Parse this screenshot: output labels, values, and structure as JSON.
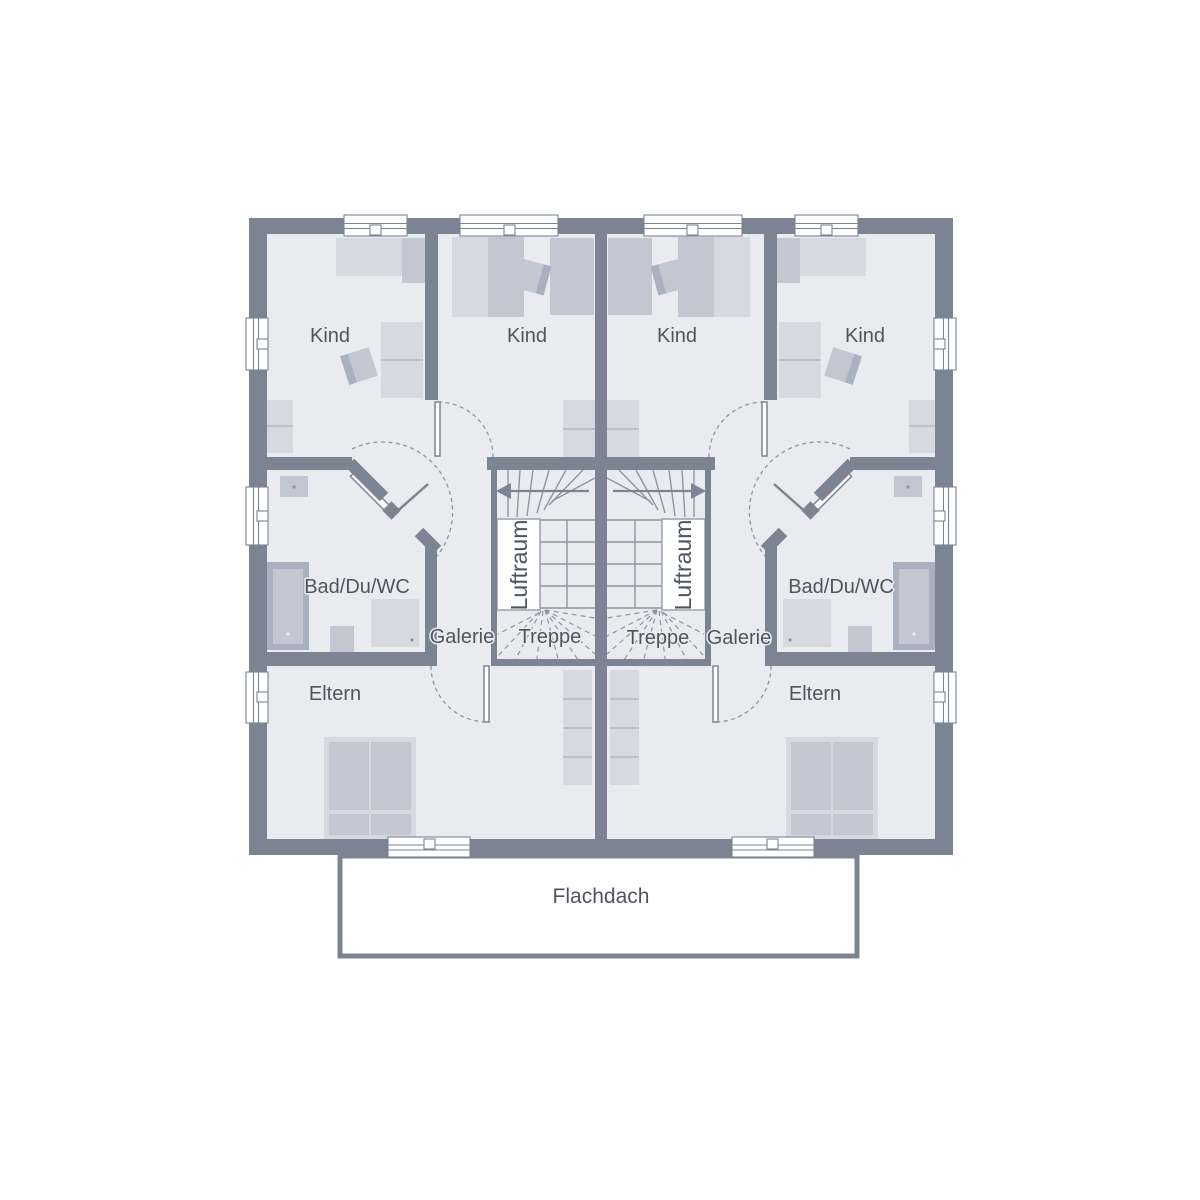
{
  "plan": {
    "type": "floor-plan",
    "building": "semi-detached duplex, upper floor, mirrored units"
  },
  "labels": {
    "kind": "Kind",
    "bad": "Bad/Du/WC",
    "galerie": "Galerie",
    "treppe": "Treppe",
    "luftraum": "Luftraum",
    "eltern": "Eltern",
    "flachdach": "Flachdach"
  },
  "rooms": [
    {
      "id": "kind-left-outer",
      "label": "Kind",
      "unit": "left"
    },
    {
      "id": "kind-left-inner",
      "label": "Kind",
      "unit": "left"
    },
    {
      "id": "kind-right-inner",
      "label": "Kind",
      "unit": "right"
    },
    {
      "id": "kind-right-outer",
      "label": "Kind",
      "unit": "right"
    },
    {
      "id": "bad-left",
      "label": "Bad/Du/WC",
      "unit": "left"
    },
    {
      "id": "bad-right",
      "label": "Bad/Du/WC",
      "unit": "right"
    },
    {
      "id": "galerie-left",
      "label": "Galerie",
      "unit": "left"
    },
    {
      "id": "galerie-right",
      "label": "Galerie",
      "unit": "right"
    },
    {
      "id": "treppe-left",
      "label": "Treppe",
      "unit": "left"
    },
    {
      "id": "treppe-right",
      "label": "Treppe",
      "unit": "right"
    },
    {
      "id": "luftraum-left",
      "label": "Luftraum",
      "unit": "left"
    },
    {
      "id": "luftraum-right",
      "label": "Luftraum",
      "unit": "right"
    },
    {
      "id": "eltern-left",
      "label": "Eltern",
      "unit": "left"
    },
    {
      "id": "eltern-right",
      "label": "Eltern",
      "unit": "right"
    },
    {
      "id": "flachdach",
      "label": "Flachdach",
      "unit": "shared"
    }
  ],
  "colors": {
    "wall": "#7c8494",
    "floor": "#e9ebf1",
    "line": "#8d95a4",
    "text": "#4f5560",
    "furn_light": "#d6d9e1",
    "furn_mid": "#c2c7d2",
    "furn_dark": "#a9b0bf",
    "furn_divider": "#b3b9c5"
  }
}
